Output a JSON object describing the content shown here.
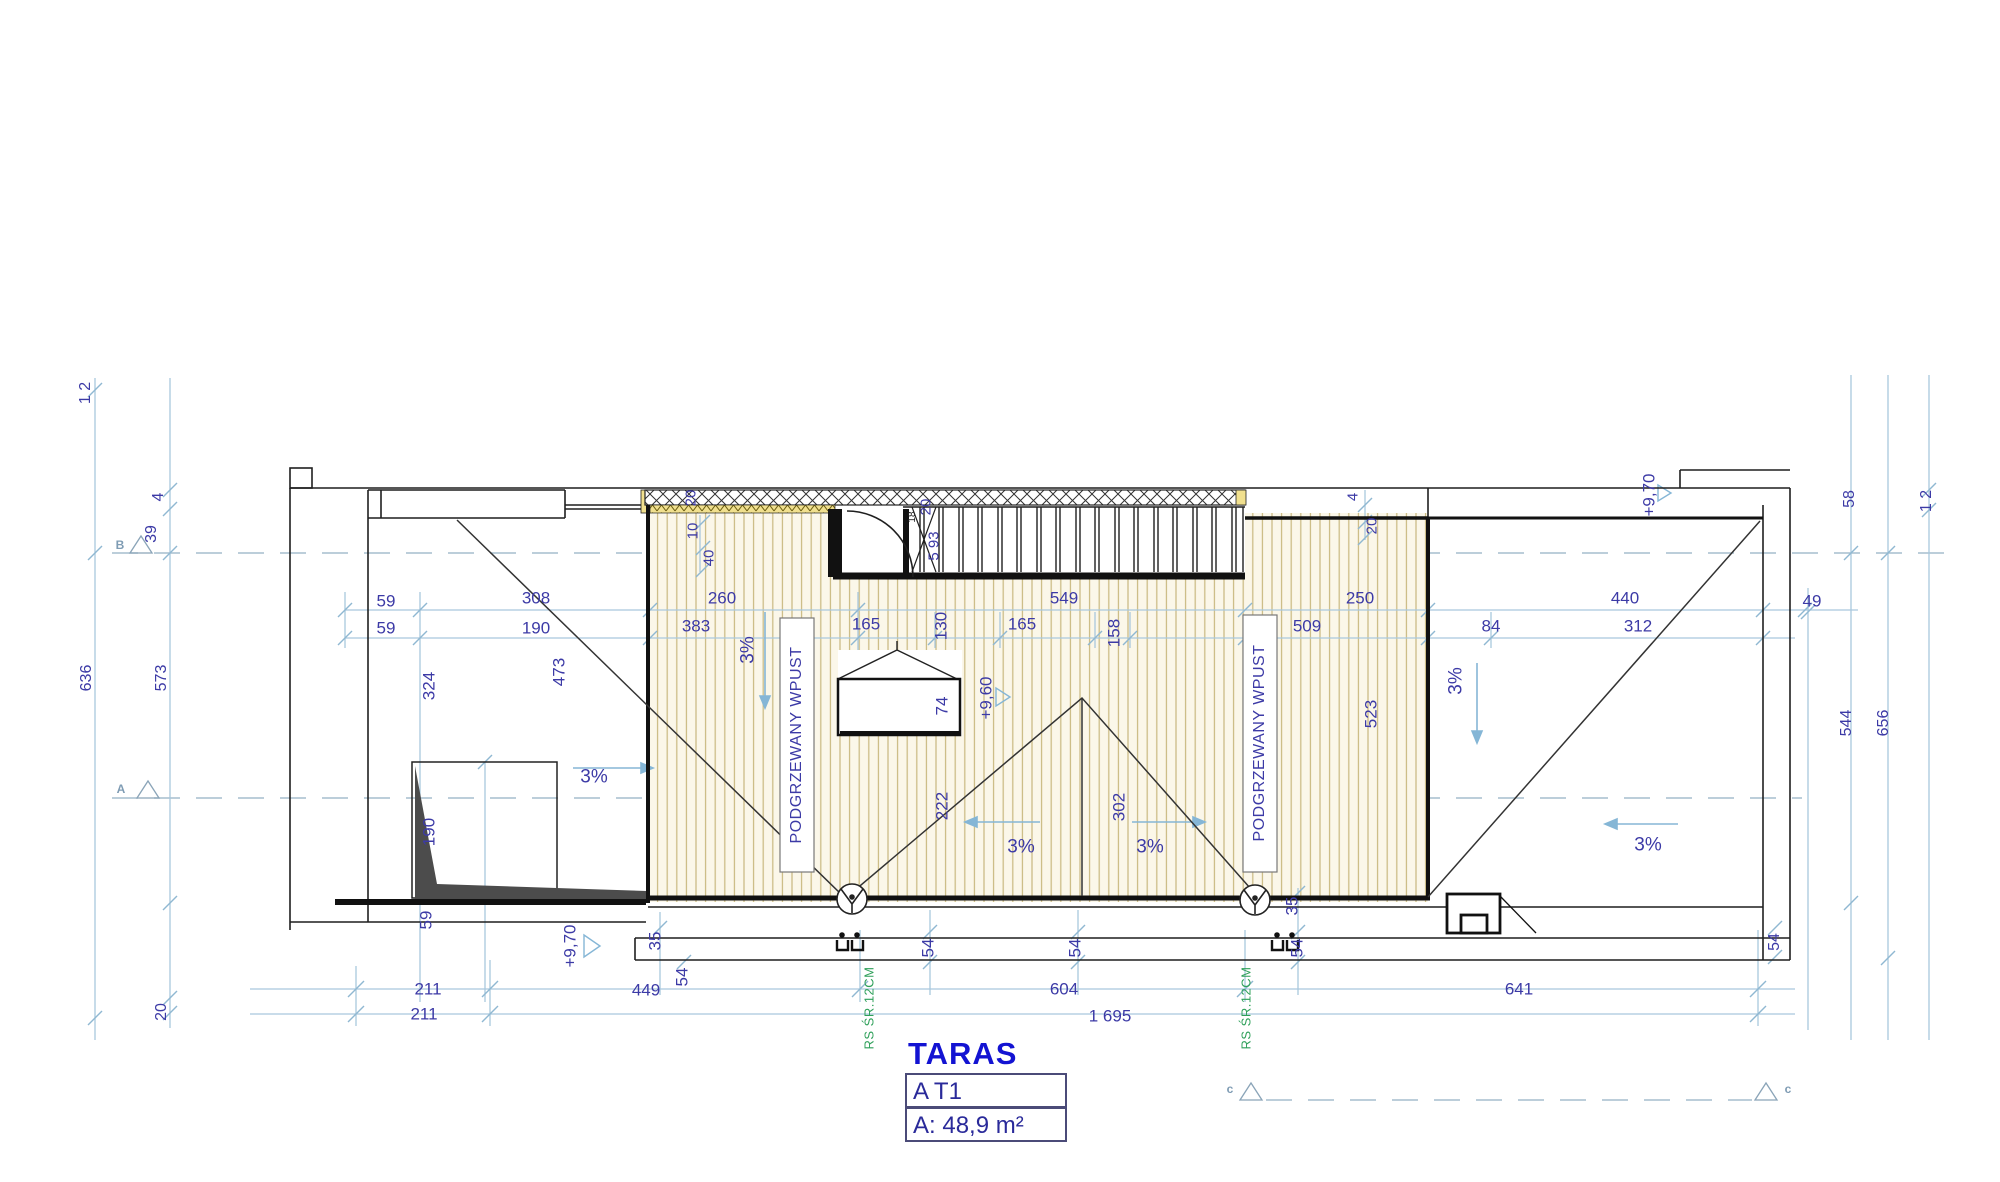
{
  "title_block": {
    "title": "TARAS",
    "unit_code": "A T1",
    "area": "A: 48,9 m²"
  },
  "section_markers": {
    "a": "A",
    "b": "B",
    "c_left": "c",
    "c_right": "c"
  },
  "levels": {
    "deck_center": "+9,60",
    "walkway_bottom": "+9,70",
    "walkway_top_right": "+9,70"
  },
  "slope_labels": [
    "3%",
    "3%",
    "3%",
    "3%",
    "3%",
    "3%"
  ],
  "annotations": {
    "drain_note_left": "RS ŚR.12CM",
    "drain_note_right": "RS ŚR.12CM",
    "heated_drain_left": "PODGRZEWANY WPUST",
    "heated_drain_right": "PODGRZEWANY WPUST"
  },
  "dimensions": {
    "row_top": [
      "59",
      "308",
      "260",
      "549",
      "250",
      "440",
      "49"
    ],
    "row_top2": [
      "59",
      "190",
      "383",
      "165",
      "130",
      "165",
      "158",
      "509",
      "84",
      "312"
    ],
    "row_bottom": [
      "211",
      "449",
      "604",
      "641"
    ],
    "row_bottom_total": [
      "211",
      "1 695"
    ],
    "left_chain": [
      "1 2",
      "4",
      "39",
      "636",
      "573",
      "20"
    ],
    "right_chain": [
      "58",
      "1 2",
      "544",
      "656",
      "54"
    ],
    "room_left": [
      "324",
      "190",
      "59"
    ],
    "deck_top": [
      "20",
      "10",
      "40",
      "20",
      "18",
      "5 93",
      "4",
      "20"
    ],
    "deck_inner": [
      "473",
      "74",
      "222",
      "302",
      "523"
    ],
    "bottom_edge": [
      "35",
      "54",
      "54",
      "54",
      "35",
      "54"
    ]
  }
}
